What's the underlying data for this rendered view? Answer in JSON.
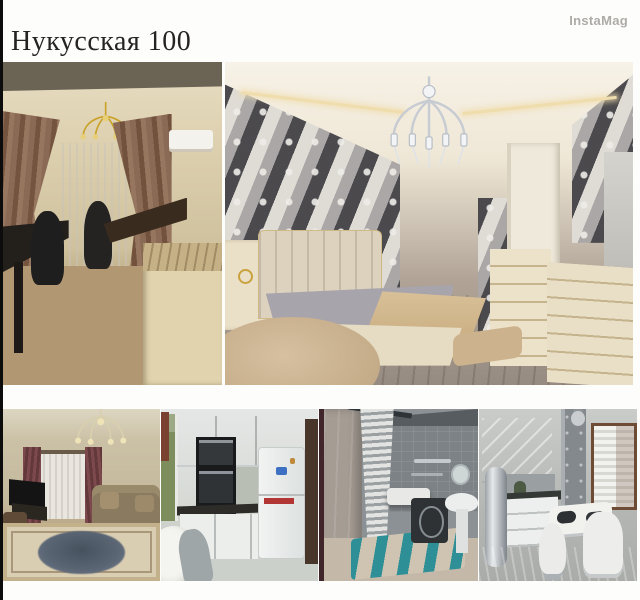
{
  "page": {
    "title": "Нукусская 100",
    "watermark": "InstaMag",
    "background_color": "#fdfdfc",
    "left_edge_line_color": "#0c0c0c",
    "title_color": "#262422",
    "watermark_color": "#aeaba7"
  },
  "collage": {
    "layout": "two large photos on top row, four small photos on bottom row",
    "photos": [
      {
        "name": "study-room",
        "description": "Home office: beige walls, dark ceiling band, gold chandelier, brown curtains with white sheer, air conditioner, black desk with two office chairs, dark wood table, cream cabinet, light wood floor",
        "dominant_colors": [
          "#d3c5a5",
          "#8b6a55",
          "#b19772"
        ]
      },
      {
        "name": "bedroom",
        "description": "Bedroom: black and white damask wallpaper, crystal chandelier, cream ceiling with cove lighting, beige curtains, cream upholstered bed with grey bedding and beige throw, round beige rug, white dresser and mirror, grey wood floor",
        "dominant_colors": [
          "#efe7d6",
          "#3a3a3e",
          "#cdb592"
        ]
      },
      {
        "name": "living-room",
        "description": "Living room: crystal chandelier, window with burgundy and sheer curtains, TV on stand, brown sofa with cushions, large ornate beige rug with dark medallion",
        "dominant_colors": [
          "#c3b89c",
          "#7c4a4c",
          "#55606c"
        ]
      },
      {
        "name": "kitchen-fridge",
        "description": "Kitchen: white glossy cabinets, black built-in oven column, dark countertop, white refrigerator with magnets, window with greenery, white round table and grey chair",
        "dominant_colors": [
          "#eceeec",
          "#191a1b",
          "#e8eae8"
        ]
      },
      {
        "name": "bathroom",
        "description": "Bathroom: grey tiled walls, striped shower curtain, chrome towel bars, bathtub, washing machine, pedestal sink, round mirror, beige floor with teal striped rug",
        "dominant_colors": [
          "#7c8286",
          "#e3e4e2",
          "#2e8f96"
        ]
      },
      {
        "name": "kitchen-grey",
        "description": "Grey kitchen: glossy grey-white cabinets, steel cylinder water heater, dark counter, grey column, window with white blinds and brown frame, small white table with dark placemats and two white stools",
        "dominant_colors": [
          "#b3b6b2",
          "#84898e",
          "#f1f1ee"
        ]
      }
    ]
  }
}
